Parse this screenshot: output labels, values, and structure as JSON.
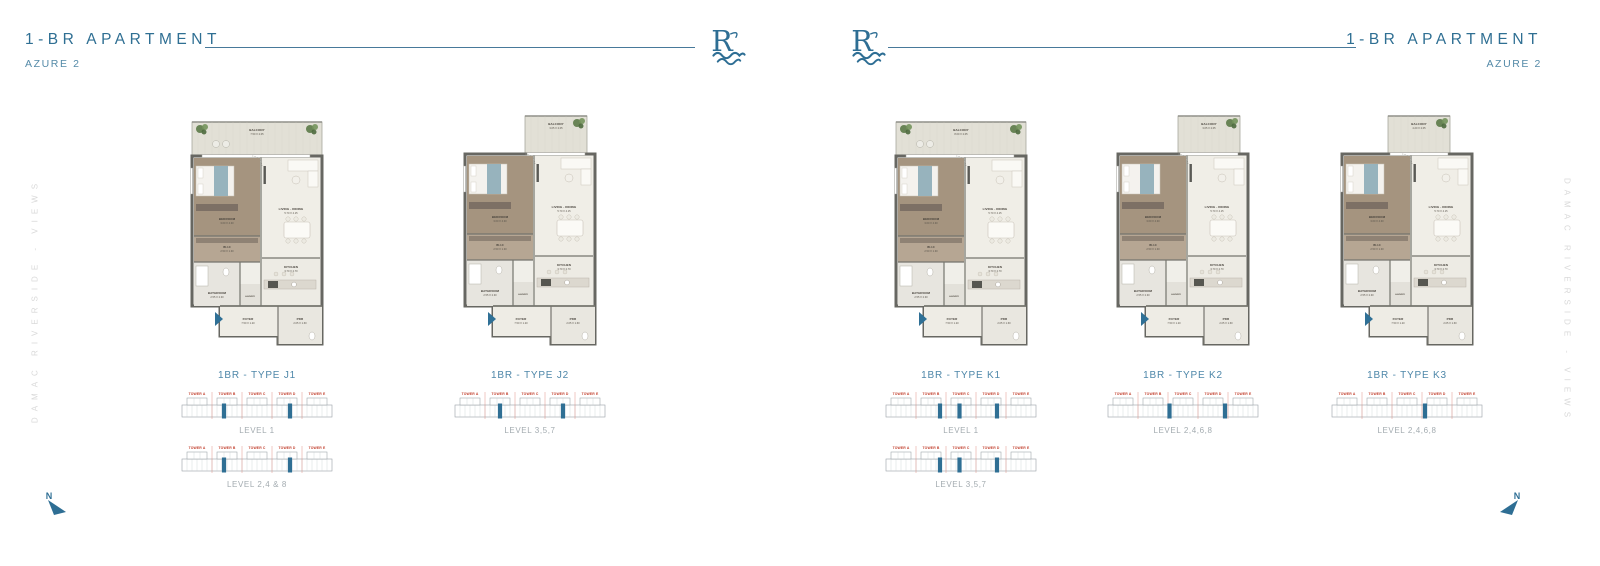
{
  "brand": {
    "logo_letter": "R",
    "side_text": "DAMAC RIVERSIDE - VIEWS"
  },
  "towers": [
    "TOWER A",
    "TOWER B",
    "TOWER C",
    "TOWER D",
    "TOWER E"
  ],
  "north": {
    "label": "N"
  },
  "colors": {
    "accent": "#2f6f93",
    "tower_red": "#c2402e",
    "keyplan_highlight": "#2f6f94",
    "level_gray": "#a3abb0"
  },
  "pages": [
    {
      "title": "1-BR APARTMENT",
      "subtitle": "AZURE 2",
      "plans": [
        {
          "type_label": "1BR - TYPE J1",
          "shape": "wide",
          "rooms": [
            {
              "name": "BALCONY",
              "dims": "7.50 X 2.05"
            },
            {
              "name": "BEDROOM",
              "dims": "3.60 X 4.30"
            },
            {
              "name": "LIVING - DINING",
              "dims": "5.70 X 4.15"
            },
            {
              "name": "W.I.C",
              "dims": "2.50 X 1.30"
            },
            {
              "name": "BATHROOM",
              "dims": "2.55 X 2.30"
            },
            {
              "name": "KITCHEN",
              "dims": "3.70 X 2.70"
            },
            {
              "name": "LAUNDRY",
              "dims": ""
            },
            {
              "name": "FOYER",
              "dims": "7.50 X 1.20"
            },
            {
              "name": "PDR",
              "dims": "2.05 X 1.60"
            }
          ],
          "keyplans": [
            {
              "level": "LEVEL 1",
              "highlights": [
                0.28,
                0.72
              ]
            },
            {
              "level": "LEVEL 2,4 & 8",
              "highlights": [
                0.28,
                0.72
              ]
            }
          ]
        },
        {
          "type_label": "1BR - TYPE J2",
          "shape": "tab",
          "rooms": [
            {
              "name": "BALCONY",
              "dims": "3.05 X 2.05"
            },
            {
              "name": "BEDROOM",
              "dims": "3.60 X 4.30"
            },
            {
              "name": "LIVING - DINING",
              "dims": "5.70 X 4.15"
            },
            {
              "name": "W.I.C",
              "dims": "2.50 X 1.30"
            },
            {
              "name": "BATHROOM",
              "dims": "2.55 X 2.30"
            },
            {
              "name": "KITCHEN",
              "dims": "3.70 X 2.70"
            },
            {
              "name": "LAUNDRY",
              "dims": ""
            },
            {
              "name": "FOYER",
              "dims": "7.50 X 1.20"
            },
            {
              "name": "PDR",
              "dims": "2.05 X 1.60"
            }
          ],
          "keyplans": [
            {
              "level": "LEVEL 3,5,7",
              "highlights": [
                0.3,
                0.72
              ]
            }
          ]
        }
      ]
    },
    {
      "title": "1-BR APARTMENT",
      "subtitle": "AZURE 2",
      "plans": [
        {
          "type_label": "1BR - TYPE K1",
          "shape": "wide",
          "rooms": [
            {
              "name": "BALCONY",
              "dims": "8.00 X 2.05"
            },
            {
              "name": "BEDROOM",
              "dims": "3.60 X 4.30"
            },
            {
              "name": "LIVING - DINING",
              "dims": "5.70 X 4.15"
            },
            {
              "name": "W.I.C",
              "dims": "2.50 X 1.30"
            },
            {
              "name": "BATHROOM",
              "dims": "2.55 X 2.30"
            },
            {
              "name": "KITCHEN",
              "dims": "3.70 X 2.70"
            },
            {
              "name": "LAUNDRY",
              "dims": ""
            },
            {
              "name": "FOYER",
              "dims": "7.50 X 1.20"
            },
            {
              "name": "PDR",
              "dims": "2.05 X 1.60"
            }
          ],
          "keyplans": [
            {
              "level": "LEVEL 1",
              "highlights": [
                0.36,
                0.49,
                0.74
              ]
            },
            {
              "level": "LEVEL 3,5,7",
              "highlights": [
                0.36,
                0.49,
                0.74
              ]
            }
          ]
        },
        {
          "type_label": "1BR - TYPE K2",
          "shape": "tab",
          "rooms": [
            {
              "name": "BALCONY",
              "dims": "3.05 X 2.05"
            },
            {
              "name": "BEDROOM",
              "dims": "3.60 X 4.30"
            },
            {
              "name": "LIVING - DINING",
              "dims": "5.70 X 4.15"
            },
            {
              "name": "W.I.C",
              "dims": "2.50 X 1.30"
            },
            {
              "name": "BATHROOM",
              "dims": "2.55 X 2.30"
            },
            {
              "name": "KITCHEN",
              "dims": "3.70 X 2.70"
            },
            {
              "name": "LAUNDRY",
              "dims": ""
            },
            {
              "name": "FOYER",
              "dims": "7.50 X 1.20"
            },
            {
              "name": "PDR",
              "dims": "2.05 X 1.60"
            }
          ],
          "keyplans": [
            {
              "level": "LEVEL 2,4,6,8",
              "highlights": [
                0.41,
                0.78
              ]
            }
          ]
        },
        {
          "type_label": "1BR - TYPE K3",
          "shape": "tab2",
          "rooms": [
            {
              "name": "BALCONY",
              "dims": "4.20 X 2.05"
            },
            {
              "name": "BEDROOM",
              "dims": "3.60 X 4.30"
            },
            {
              "name": "LIVING - DINING",
              "dims": "5.70 X 4.15"
            },
            {
              "name": "W.I.C",
              "dims": "2.50 X 1.30"
            },
            {
              "name": "BATHROOM",
              "dims": "2.55 X 2.30"
            },
            {
              "name": "KITCHEN",
              "dims": "3.70 X 2.70"
            },
            {
              "name": "LAUNDRY",
              "dims": ""
            },
            {
              "name": "FOYER",
              "dims": "7.50 X 1.20"
            },
            {
              "name": "PDR",
              "dims": "2.05 X 1.60"
            }
          ],
          "keyplans": [
            {
              "level": "LEVEL 2,4,6,8",
              "highlights": [
                0.62
              ]
            }
          ]
        }
      ]
    }
  ]
}
